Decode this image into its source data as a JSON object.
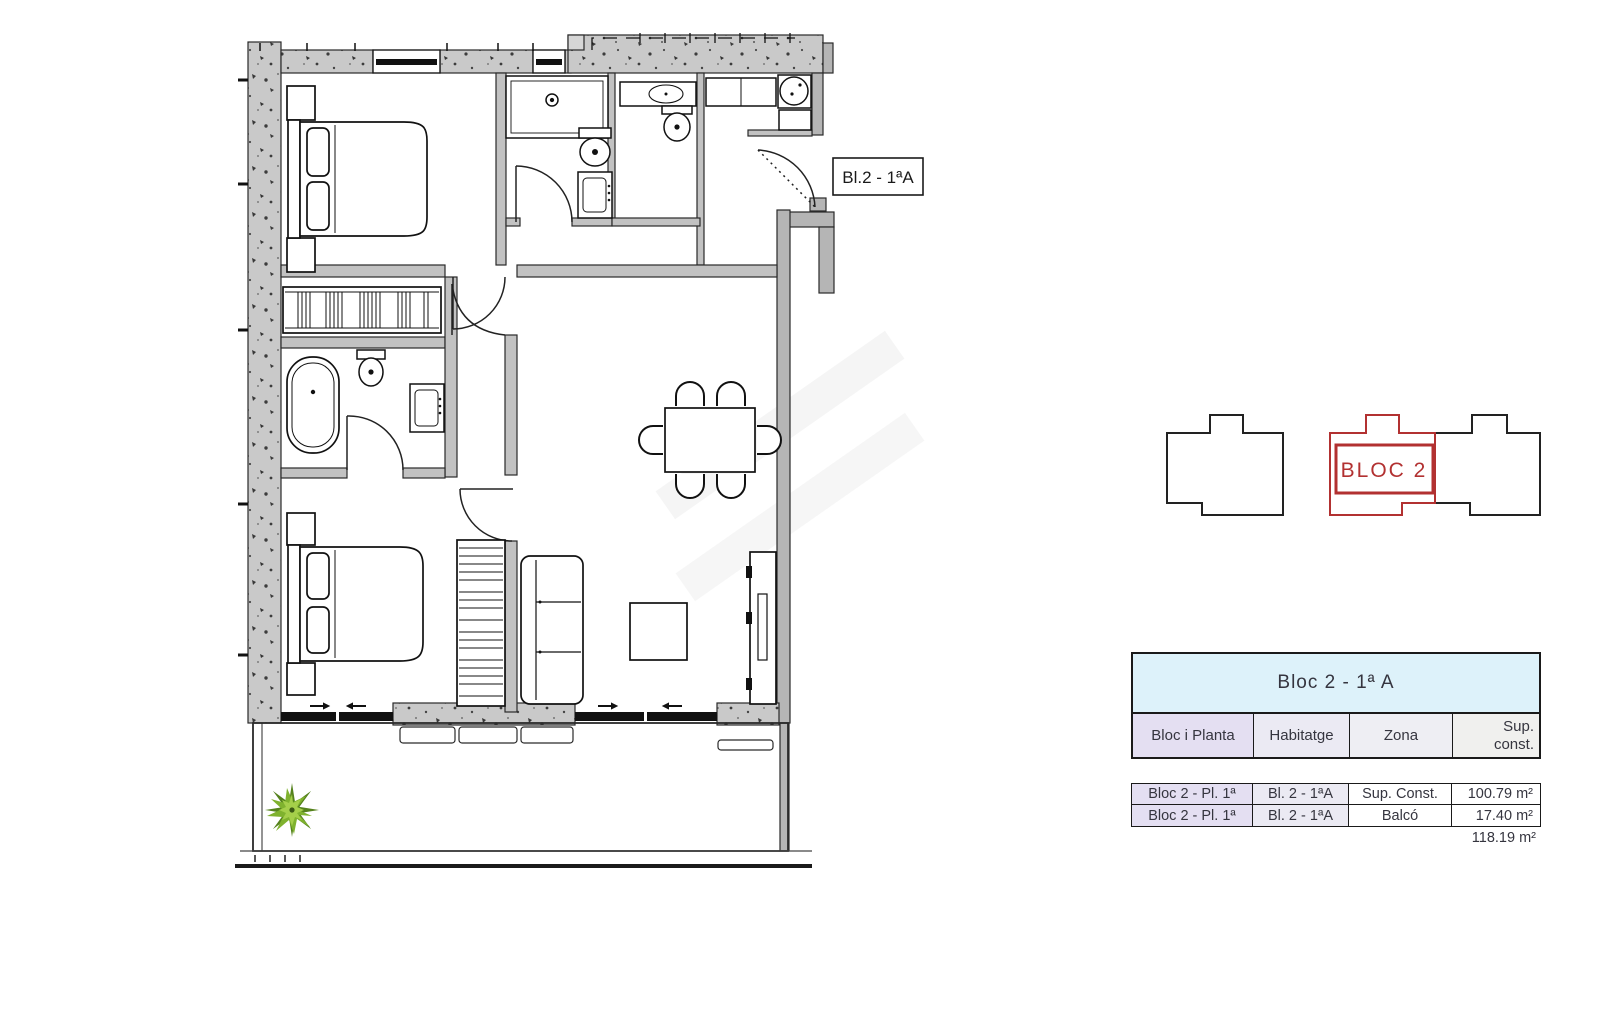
{
  "plan": {
    "unit_label": "Bl.2 - 1ªA"
  },
  "locator": {
    "bloc_label": "BLOC 2",
    "highlight_color": "#b23131",
    "outline_color": "#222222"
  },
  "summary_table": {
    "title": "Bloc  2 - 1ª A",
    "columns": [
      "Bloc i Planta",
      "Habitatge",
      "Zona",
      "Sup.\nconst."
    ],
    "rows": [
      {
        "bloc_planta": "Bloc 2 - Pl. 1ª",
        "habitatge": "Bl. 2 - 1ªA",
        "zona": "Sup. Const.",
        "sup": "100.79 m²"
      },
      {
        "bloc_planta": "Bloc 2 - Pl. 1ª",
        "habitatge": "Bl. 2 - 1ªA",
        "zona": "Balcó",
        "sup": "17.40 m²"
      }
    ],
    "total": "118.19 m²",
    "colors": {
      "title_bg": "#ddf2fa",
      "header_col1_bg": "#e4dff2",
      "row_label_bg": "#e5e1f2",
      "border": "#1a1a1a"
    }
  }
}
